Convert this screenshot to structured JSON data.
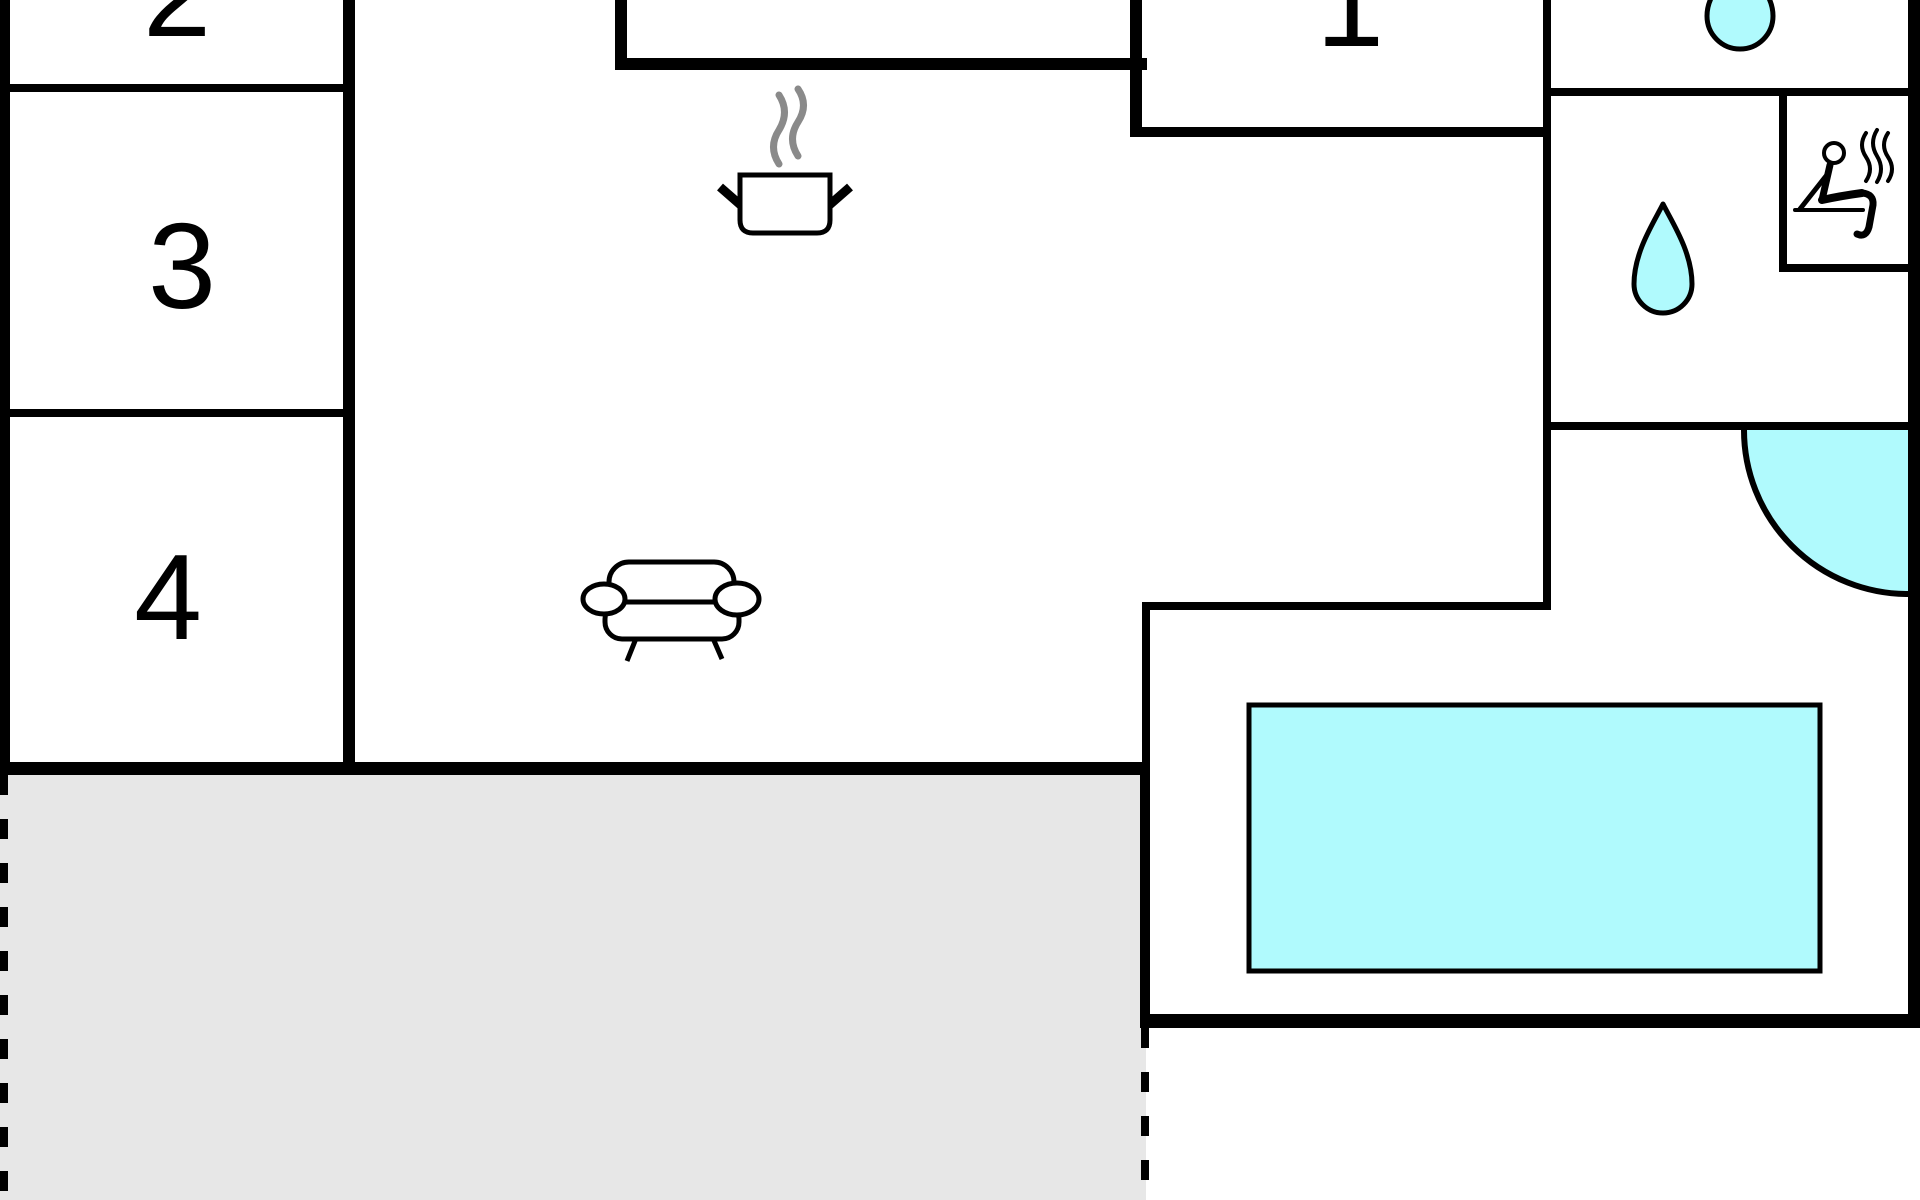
{
  "rooms": {
    "room1": {
      "label": "1"
    },
    "room2": {
      "label": "2"
    },
    "room3": {
      "label": "3"
    },
    "room4": {
      "label": "4"
    }
  },
  "colors": {
    "wall": "#000000",
    "water_fill": "#b0fafd",
    "terrace_fill": "#e7e7e7",
    "steam_gray": "#8a8a8a",
    "background": "#ffffff"
  },
  "icons": {
    "cooking_pot": "pot-with-steam-lines",
    "sofa": "sofa-top-view-with-armrests",
    "water_drop_large": "teardrop-shape",
    "water_drop_small": "teardrop-shape-cropped-at-top",
    "sauna": "person-reclining-on-bench-with-heat-waves",
    "door_swing": "quarter-circle-door-swing-arc",
    "pool": "rectangular-water-basin",
    "terrace": "gray-area-with-dashed-boundary"
  }
}
